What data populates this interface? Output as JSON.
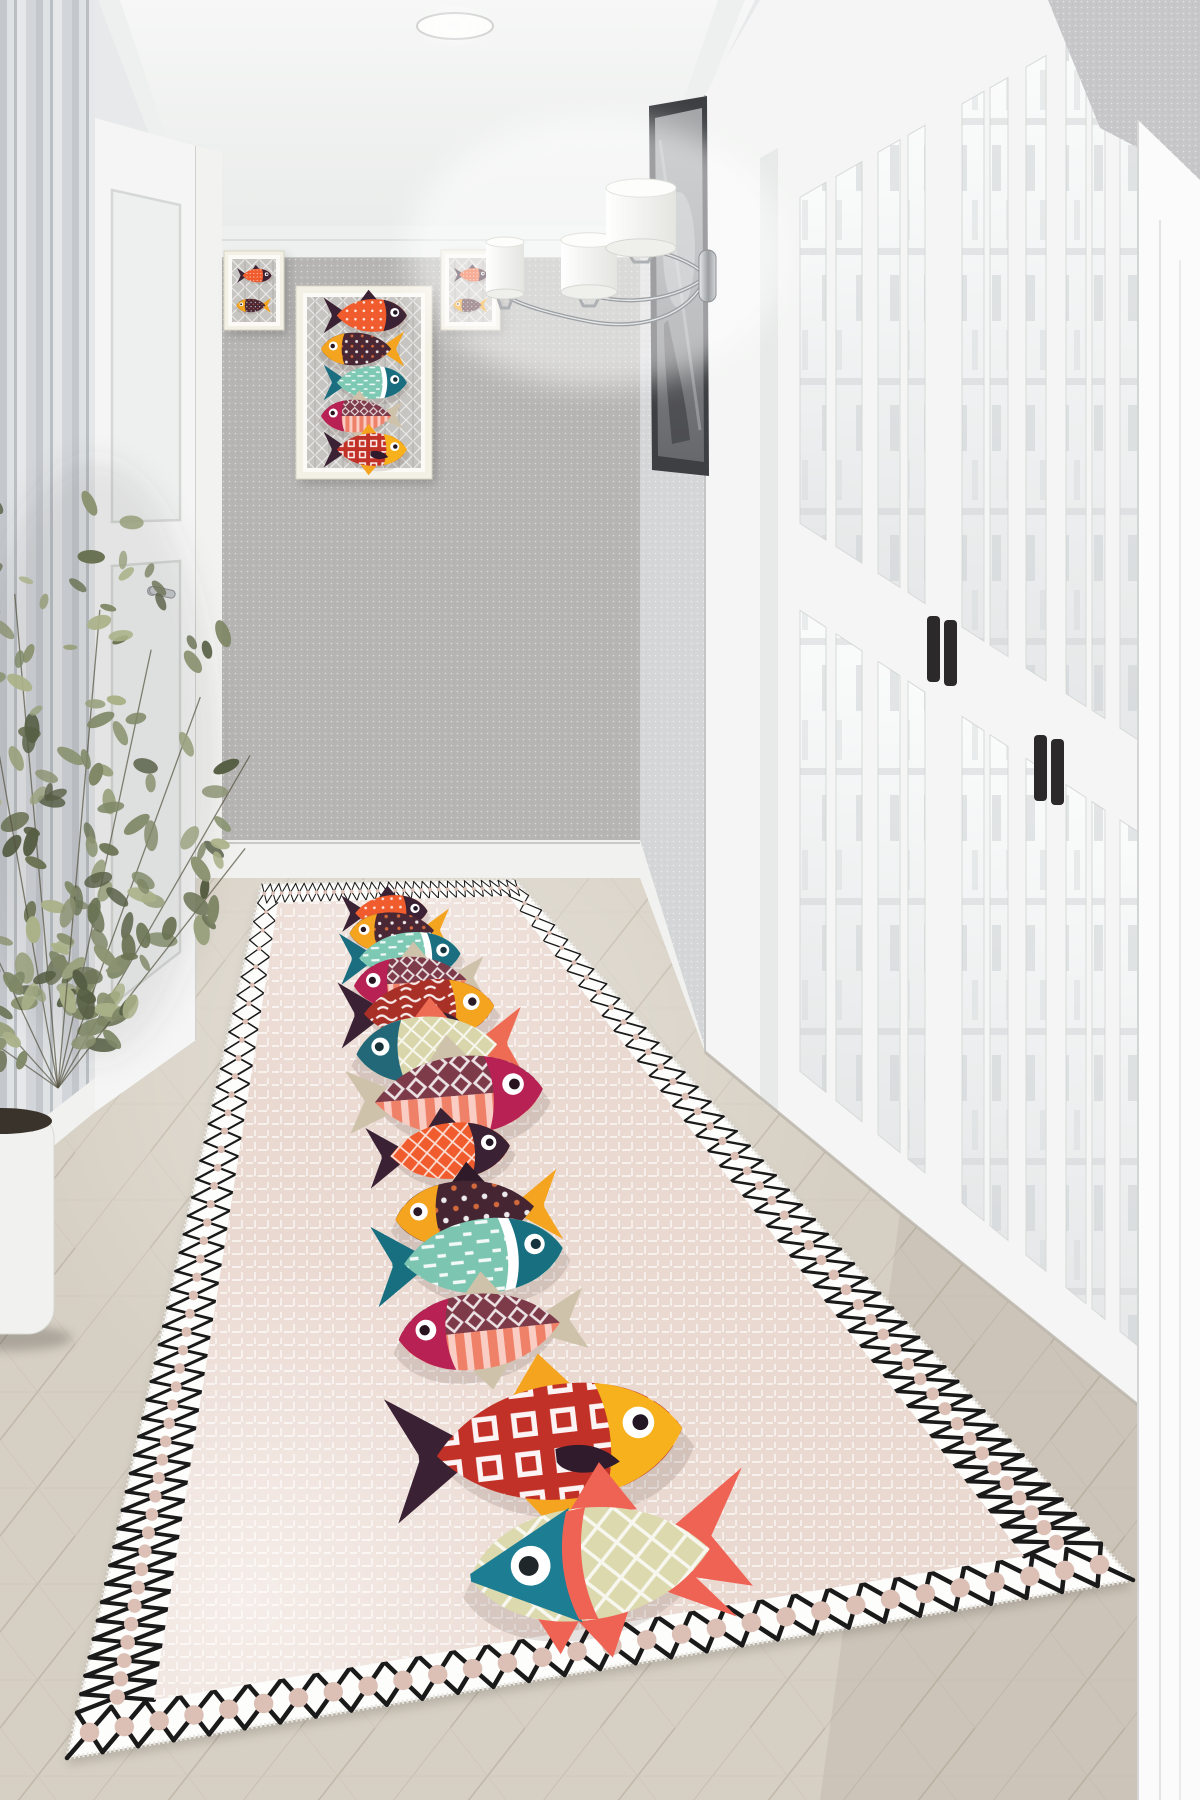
{
  "meta": {
    "description": "Photoreal hallway interior: beige runner rug decorated with a vertical column of thirteen colorful patterned fish, black diamond-lattice border; three fish art prints on the grey end wall; chrome triple wall sconce; tall dark picture; white glazed french doors with black handles on the right; striped wallpaper, white door and leafy potted plant on the left; light herringbone wood floor; recessed ceiling spotlight."
  },
  "palette": {
    "ceiling_top": "#f6f7f6",
    "ceiling_bottom": "#eaeceb",
    "crown": "#eef0ef",
    "crown_edge": "#cbcdcc",
    "end_wall": "#b6b5b3",
    "right_wall": "#d5d6d8",
    "top_patch": "#c7c7c9",
    "baseboard": "#f1f1ef",
    "baseboard_line": "#c9c9c7",
    "stripe_a": "#ccd1d6",
    "stripe_b": "#e9ecef",
    "stripe_c": "#c2c7cd",
    "stripe_d": "#eff1f3",
    "stripe_e": "#dbdfe3",
    "door_white": "#f4f5f4",
    "door_shade": "#e3e5e4",
    "glass_hi": "#fafbfb",
    "glass_lo": "#e6e8e9",
    "glass_detail": "#ccd0d1",
    "muntin_line": "#d8dad9",
    "handle": "#2c292a",
    "wood_base": "#d6cfc3",
    "wood_line1": "#b8ae9e",
    "wood_line2": "#c2b8a8",
    "wood_line3": "#cdc5b7",
    "pic_frame": "#3e3f42",
    "pic_hi": "#a3a5a7",
    "pic_lo": "#66686b",
    "art_frame": "#f3f0e6",
    "art_mat": "#fbfaf6",
    "art_bg": "#c7c5c1",
    "art_hatch": "#ffffff",
    "art_hatch2": "#8f8d89",
    "chrome_hi": "#e8eaec",
    "chrome_mid": "#9b9ea1",
    "chrome_lo": "#d6d8da",
    "shade_hi": "#ffffff",
    "shade_lo": "#e4e4e0",
    "plant_stem": "#54523f",
    "pot": "#f1f1ef",
    "soil": "#3a332b"
  },
  "recessed_light": {
    "cx": 455,
    "cy": 26,
    "rx": 38,
    "ry": 13
  },
  "geometry": {
    "ceiling": [
      [
        115,
        0
      ],
      [
        755,
        0
      ],
      [
        640,
        232
      ],
      [
        196,
        232
      ]
    ],
    "crown_end": [
      [
        182,
        226
      ],
      [
        640,
        226
      ],
      [
        640,
        258
      ],
      [
        182,
        258
      ]
    ],
    "crown_right": [
      [
        640,
        226
      ],
      [
        718,
        0
      ],
      [
        745,
        0
      ],
      [
        640,
        262
      ]
    ],
    "crown_left": [
      [
        196,
        224
      ],
      [
        120,
        0
      ],
      [
        98,
        0
      ],
      [
        196,
        258
      ]
    ],
    "end_wall": [
      196,
      258,
      640,
      840
    ],
    "end_base": [
      196,
      840,
      640,
      878
    ],
    "right_wall": [
      [
        640,
        258
      ],
      [
        705,
        100
      ],
      [
        705,
        1048
      ],
      [
        640,
        840
      ]
    ],
    "right_base": [
      [
        640,
        840
      ],
      [
        705,
        1048
      ],
      [
        705,
        1094
      ],
      [
        640,
        878
      ]
    ],
    "top_right_patch": [
      [
        1048,
        0
      ],
      [
        1200,
        0
      ],
      [
        1200,
        180
      ],
      [
        1100,
        128
      ]
    ],
    "bright_panel": [
      [
        1138,
        120
      ],
      [
        1200,
        180
      ],
      [
        1200,
        1800
      ],
      [
        1138,
        1800
      ]
    ],
    "stripe_wall": [
      [
        0,
        0
      ],
      [
        95,
        0
      ],
      [
        95,
        1078
      ],
      [
        0,
        1152
      ]
    ],
    "left_base": [
      [
        0,
        1152
      ],
      [
        95,
        1078
      ],
      [
        95,
        1112
      ],
      [
        0,
        1190
      ]
    ],
    "left_casing": [
      [
        196,
        146
      ],
      [
        222,
        152
      ],
      [
        222,
        1036
      ],
      [
        196,
        1040
      ]
    ],
    "floor": [
      [
        196,
        878
      ],
      [
        640,
        878
      ],
      [
        705,
        1052
      ],
      [
        900,
        1213
      ],
      [
        1200,
        1455
      ],
      [
        1200,
        1800
      ],
      [
        0,
        1800
      ],
      [
        0,
        1190
      ],
      [
        95,
        1112
      ],
      [
        196,
        1040
      ]
    ]
  },
  "left_door": {
    "quad": [
      [
        95,
        118
      ],
      [
        196,
        146
      ],
      [
        196,
        1040
      ],
      [
        95,
        1112
      ]
    ],
    "panel1": [
      [
        112,
        190
      ],
      [
        180,
        205
      ],
      [
        180,
        520
      ],
      [
        112,
        522
      ]
    ],
    "panel2": [
      [
        112,
        566
      ],
      [
        180,
        561
      ],
      [
        180,
        952
      ],
      [
        112,
        1005
      ]
    ],
    "handle": [
      152,
      588
    ]
  },
  "door_wall": {
    "base": [
      [
        705,
        95
      ],
      [
        760,
        0
      ],
      [
        1200,
        0
      ],
      [
        1200,
        1455
      ],
      [
        900,
        1213
      ],
      [
        705,
        1052
      ]
    ],
    "top_line": {
      "x0": 705,
      "y0": 190,
      "m": -0.576
    },
    "bottom_line": {
      "x0": 705,
      "y0": 1052,
      "m": 0.813
    },
    "rail": {
      "x0": 940,
      "y1": 613,
      "m1": 0.64,
      "y2": 702,
      "m2": 0.655
    },
    "glass_top_offset": 62,
    "glass_bottom_offset": 58,
    "casing_inner": [
      [
        760,
        158
      ],
      [
        778,
        148
      ],
      [
        778,
        1115
      ],
      [
        760,
        1100
      ]
    ],
    "glass_cols": [
      [
        800,
        826
      ],
      [
        836,
        862
      ],
      [
        878,
        900
      ],
      [
        908,
        925
      ],
      [
        962,
        984
      ],
      [
        990,
        1008
      ],
      [
        1026,
        1046
      ],
      [
        1066,
        1086
      ],
      [
        1092,
        1105
      ],
      [
        1120,
        1143
      ]
    ],
    "handles": [
      [
        927,
        616
      ],
      [
        944,
        620
      ],
      [
        1034,
        735
      ],
      [
        1051,
        739
      ]
    ],
    "handle_size": [
      13,
      66
    ]
  },
  "right_picture": {
    "outer": [
      [
        649,
        106
      ],
      [
        707,
        96
      ],
      [
        709,
        476
      ],
      [
        652,
        470
      ]
    ],
    "inner": [
      [
        655,
        118
      ],
      [
        702,
        108
      ],
      [
        704,
        462
      ],
      [
        658,
        456
      ]
    ]
  },
  "art": {
    "frames": [
      {
        "name": "left-small",
        "x": 224,
        "y": 251,
        "w": 60,
        "h": 79,
        "refs": [
          0,
          1
        ]
      },
      {
        "name": "center",
        "x": 296,
        "y": 286,
        "w": 136,
        "h": 193,
        "refs": [
          0,
          1,
          2,
          3,
          11
        ]
      },
      {
        "name": "right-small",
        "x": 441,
        "y": 250,
        "w": 59,
        "h": 80,
        "refs": [
          0,
          1
        ]
      }
    ]
  },
  "sconce": {
    "plate": [
      699,
      250,
      17,
      52
    ],
    "glow": [
      598,
      252,
      190,
      135
    ],
    "shades": [
      {
        "cx": 505,
        "y": 240,
        "rx": 19,
        "h": 54
      },
      {
        "cx": 589,
        "y": 238,
        "rx": 28,
        "h": 54
      },
      {
        "cx": 641,
        "y": 186,
        "rx": 35,
        "h": 62
      }
    ],
    "arms": [
      "M 707 276 C 688 318 640 330 592 322 C 560 316 520 306 505 295",
      "M 707 276 C 676 300 630 306 590 295",
      "M 707 276 C 692 262 668 252 641 249"
    ]
  },
  "plant": {
    "base": [
      58,
      1088
    ],
    "branches": [
      [
        -95,
        620
      ],
      [
        -115,
        540
      ],
      [
        -78,
        560
      ],
      [
        -132,
        430
      ],
      [
        -60,
        480
      ],
      [
        -100,
        650
      ],
      [
        -85,
        600
      ],
      [
        -70,
        520
      ],
      [
        -145,
        360
      ],
      [
        -52,
        380
      ]
    ],
    "leaves_per_branch": 26,
    "seed": 11,
    "leaf_colors": [
      "#6b7355",
      "#7e8766",
      "#99a17e",
      "#565e44",
      "#aab189",
      "#8b9372"
    ],
    "pot": {
      "x": -50,
      "y": 1112,
      "w": 104,
      "h": 222,
      "r": 26
    },
    "soil": [
      2,
      1121,
      50,
      13
    ]
  },
  "rug": {
    "quad": {
      "far_left": [
        262,
        884
      ],
      "far_right": [
        515,
        880
      ],
      "near_right": [
        1133,
        1580
      ],
      "near_left": [
        67,
        1758
      ]
    },
    "base": "#ead9d1",
    "border_bg": "#fdfdfc",
    "lattice": "#1a1a1a",
    "dot": "#dcc0b6",
    "border_u": 0.075,
    "border_v_far": 0.022,
    "border_v_near": 0.052,
    "lattice_n_ends": 30,
    "lattice_n_sides": 44,
    "fish": [
      {
        "name": "small-orange",
        "u": 0.47,
        "v": 0.038,
        "len": 0.34,
        "facing": "right",
        "head_shape": "cap",
        "tail_shape": "fork",
        "body": "#f05c2d",
        "head": "#3a2133",
        "tail": "#3a2133",
        "top_fin": "#3a2133",
        "bottom_fin": null,
        "collar": null,
        "pectoral": null,
        "pattern": "pDots",
        "eye": "#ffffff",
        "pupil": "#231624"
      },
      {
        "name": "yellowhead-maroon",
        "u": 0.48,
        "v": 0.063,
        "len": 0.37,
        "facing": "left",
        "head_shape": "cap",
        "tail_shape": "fork",
        "body": "#4a2734",
        "head": "#f4a41e",
        "tail": "#f4a41e",
        "top_fin": null,
        "bottom_fin": null,
        "collar": null,
        "pectoral": null,
        "pattern": "pDots2",
        "eye": "#ffffff",
        "pupil": "#2b1a25"
      },
      {
        "name": "mint-teal",
        "u": 0.49,
        "v": 0.094,
        "len": 0.41,
        "facing": "right",
        "head_shape": "cap",
        "tail_shape": "fork",
        "body": "#7ec9b3",
        "head": "#1a6e80",
        "tail": "#1a6e80",
        "top_fin": null,
        "bottom_fin": null,
        "collar": "#ffffff",
        "pectoral": null,
        "pattern": "pDash",
        "eye": "#ffffff",
        "pupil": "#14333d"
      },
      {
        "name": "split-coral-a",
        "u": 0.5,
        "v": 0.128,
        "len": 0.42,
        "facing": "left",
        "head_shape": "cap",
        "tail_shape": "fan",
        "split": true,
        "body_top": "#7d3b4a",
        "body_bottom": "#ef8168",
        "head": "#b72153",
        "tail": "#cfc2ab",
        "top_fin": "#cfc2ab",
        "bottom_fin": "#cfc2ab",
        "collar": null,
        "pectoral": null,
        "pattern_top": "pDiamond",
        "pattern_bottom": "pStripeV",
        "eye": "#ffffff",
        "pupil": "#27141f"
      },
      {
        "name": "red-scribble",
        "u": 0.5,
        "v": 0.163,
        "len": 0.45,
        "facing": "right",
        "head_shape": "cap",
        "tail_shape": "fork",
        "body": "#a93026",
        "head": "#f4a41e",
        "tail": "#3a2133",
        "top_fin": null,
        "bottom_fin": null,
        "collar": null,
        "pectoral": "#3a2133",
        "pattern": "pScribble",
        "eye": "#ffffff",
        "pupil": "#2b1a25"
      },
      {
        "name": "cream-tealhead",
        "u": 0.5,
        "v": 0.212,
        "len": 0.44,
        "facing": "left",
        "head_shape": "cap",
        "tail_shape": "fork",
        "body": "#d8d6aa",
        "head": "#236879",
        "tail": "#ee6b54",
        "top_fin": "#ee6b54",
        "bottom_fin": "#ee6b54",
        "collar": null,
        "pectoral": null,
        "pattern": "pHatch",
        "eye": "#ffffff",
        "pupil": "#173137"
      },
      {
        "name": "split-coral-b",
        "u": 0.51,
        "v": 0.273,
        "len": 0.47,
        "facing": "right",
        "head_shape": "cap",
        "tail_shape": "fan",
        "split": true,
        "body_top": "#7d3b4a",
        "body_bottom": "#ef8168",
        "head": "#b72153",
        "tail": "#cfc2ab",
        "top_fin": "#cfc2ab",
        "bottom_fin": "#cfc2ab",
        "collar": null,
        "pectoral": null,
        "pattern_top": "pDiamond",
        "pattern_bottom": "pStripeV",
        "eye": "#ffffff",
        "pupil": "#27141f"
      },
      {
        "name": "big-orange",
        "u": 0.47,
        "v": 0.34,
        "len": 0.3,
        "facing": "right",
        "head_shape": "cap",
        "tail_shape": "fork",
        "body": "#f05c2d",
        "head": "#3a2133",
        "tail": "#3a2133",
        "top_fin": "#3a2133",
        "bottom_fin": null,
        "collar": null,
        "pectoral": null,
        "pattern": "pHatch",
        "eye": "#ffffff",
        "pupil": "#231624"
      },
      {
        "name": "yellowhead-maroon-big",
        "u": 0.49,
        "v": 0.419,
        "len": 0.31,
        "facing": "left",
        "head_shape": "cap",
        "tail_shape": "fork",
        "body": "#452532",
        "head": "#f4a41e",
        "tail": "#f4a41e",
        "top_fin": "#2e1a28",
        "bottom_fin": null,
        "collar": null,
        "pectoral": null,
        "pattern": "pDots2",
        "eye": "#ffffff",
        "pupil": "#2b1a25"
      },
      {
        "name": "big-teal",
        "u": 0.48,
        "v": 0.474,
        "len": 0.33,
        "facing": "right",
        "head_shape": "cap",
        "tail_shape": "fork",
        "body": "#7cc5b0",
        "head": "#176f80",
        "tail": "#176f80",
        "top_fin": null,
        "bottom_fin": null,
        "collar": "#ffffff",
        "pectoral": null,
        "pattern": "pDash",
        "eye": "#ffffff",
        "pupil": "#14333d"
      },
      {
        "name": "split-coral-c",
        "u": 0.47,
        "v": 0.566,
        "len": 0.3,
        "facing": "left",
        "head_shape": "cap",
        "tail_shape": "fan",
        "split": true,
        "body_top": "#7d3b4a",
        "body_bottom": "#ef8168",
        "head": "#b72153",
        "tail": "#cfc2ab",
        "top_fin": "#cfc2ab",
        "bottom_fin": "#cfc2ab",
        "collar": null,
        "pectoral": null,
        "pattern_top": "pDiamond",
        "pattern_bottom": "pStripeV",
        "eye": "#ffffff",
        "pupil": "#27141f"
      },
      {
        "name": "red-diamond",
        "u": 0.51,
        "v": 0.715,
        "len": 0.39,
        "facing": "right",
        "head_shape": "cap",
        "tail_shape": "fork",
        "body": "#c23127",
        "head": "#f6b11c",
        "tail": "#3a2133",
        "top_fin": "#f4a41e",
        "bottom_fin": "#f4a41e",
        "collar": null,
        "pectoral": "#2f1b2b",
        "pattern": "pSquares",
        "eye": "#ffffff",
        "pupil": "#231624"
      },
      {
        "name": "big-bottom",
        "u": 0.53,
        "v": 0.87,
        "len": 0.33,
        "facing": "left",
        "head_shape": "tri",
        "tail_shape": "fork13",
        "body": "#dbd9ad",
        "head": "#1d7d92",
        "tail": "#ef6355",
        "top_fin": "#ef6355",
        "bottom_fin": "#ef6355",
        "collar": "#ef6355",
        "pectoral": null,
        "pattern": "pHatch",
        "eye": "#ffffff",
        "pupil": "#20272b"
      }
    ]
  }
}
